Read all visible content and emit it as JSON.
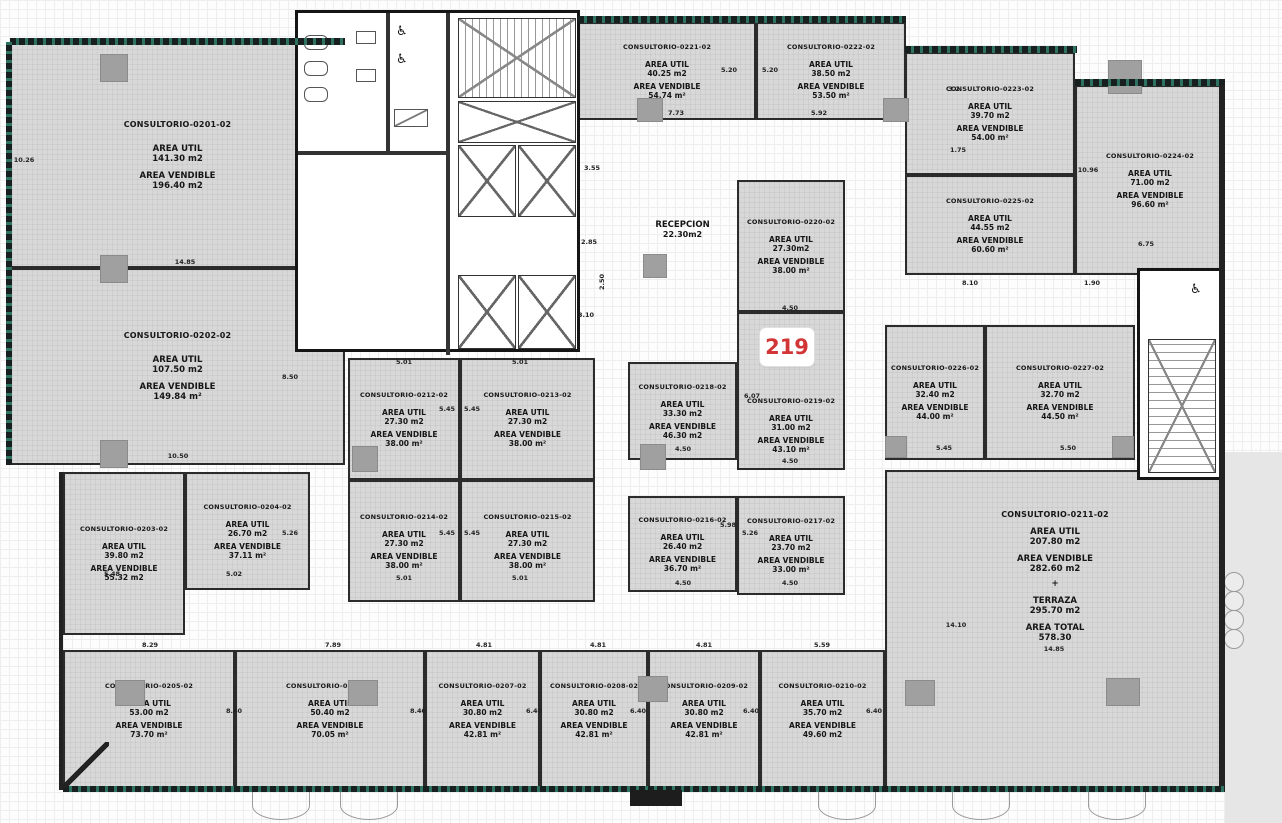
{
  "labels": {
    "area_util": "AREA UTIL",
    "area_vendible": "AREA VENDIBLE"
  },
  "marker": {
    "text": "219"
  },
  "reception": {
    "name": "RECEPCION",
    "area": "22.30m2"
  },
  "icons": {
    "wheelchair": "♿"
  },
  "rooms": [
    {
      "name": "CONSULTORIO-0201-02",
      "util": "141.30 m2",
      "vend": "196.40 m2"
    },
    {
      "name": "CONSULTORIO-0202-02",
      "util": "107.50 m2",
      "vend": "149.84 m²"
    },
    {
      "name": "CONSULTORIO-0203-02",
      "util": "39.80 m2",
      "vend": "55.32 m2"
    },
    {
      "name": "CONSULTORIO-0204-02",
      "util": "26.70 m2",
      "vend": "37.11 m²"
    },
    {
      "name": "CONSULTORIO-0205-02",
      "util": "53.00 m2",
      "vend": "73.70 m²"
    },
    {
      "name": "CONSULTORIO-0206-02",
      "util": "50.40 m2",
      "vend": "70.05 m²"
    },
    {
      "name": "CONSULTORIO-0207-02",
      "util": "30.80 m2",
      "vend": "42.81 m²"
    },
    {
      "name": "CONSULTORIO-0208-02",
      "util": "30.80 m2",
      "vend": "42.81 m²"
    },
    {
      "name": "CONSULTORIO-0209-02",
      "util": "30.80 m2",
      "vend": "42.81 m²"
    },
    {
      "name": "CONSULTORIO-0210-02",
      "util": "35.70 m2",
      "vend": "49.60 m2"
    },
    {
      "name": "CONSULTORIO-0211-02",
      "util": "207.80 m2",
      "vend": "282.60 m2",
      "plus": "+",
      "terraza_label": "TERRAZA",
      "terraza": "295.70 m2",
      "total_label": "AREA TOTAL",
      "total": "578.30"
    },
    {
      "name": "CONSULTORIO-0212-02",
      "util": "27.30 m2",
      "vend": "38.00 m²"
    },
    {
      "name": "CONSULTORIO-0213-02",
      "util": "27.30 m2",
      "vend": "38.00 m²"
    },
    {
      "name": "CONSULTORIO-0214-02",
      "util": "27.30 m2",
      "vend": "38.00 m²"
    },
    {
      "name": "CONSULTORIO-0215-02",
      "util": "27.30 m2",
      "vend": "38.00 m²"
    },
    {
      "name": "CONSULTORIO-0216-02",
      "util": "26.40 m2",
      "vend": "36.70 m²"
    },
    {
      "name": "CONSULTORIO-0217-02",
      "util": "23.70 m2",
      "vend": "33.00 m²"
    },
    {
      "name": "CONSULTORIO-0218-02",
      "util": "33.30 m2",
      "vend": "46.30 m2"
    },
    {
      "name": "CONSULTORIO-0219-02",
      "util": "31.00 m2",
      "vend": "43.10 m²"
    },
    {
      "name": "CONSULTORIO-0220-02",
      "util": "27.30m2",
      "vend": "38.00 m²"
    },
    {
      "name": "CONSULTORIO-0221-02",
      "util": "40.25 m2",
      "vend": "54.74 m²"
    },
    {
      "name": "CONSULTORIO-0222-02",
      "util": "38.50 m2",
      "vend": "53.50 m²"
    },
    {
      "name": "CONSULTORIO-0223-02",
      "util": "39.70 m2",
      "vend": "54.00 m²"
    },
    {
      "name": "CONSULTORIO-0224-02",
      "util": "71.00 m2",
      "vend": "96.60 m²"
    },
    {
      "name": "CONSULTORIO-0225-02",
      "util": "44.55 m2",
      "vend": "60.60 m²"
    },
    {
      "name": "CONSULTORIO-0226-02",
      "util": "32.40 m2",
      "vend": "44.00 m²"
    },
    {
      "name": "CONSULTORIO-0227-02",
      "util": "32.70 m2",
      "vend": "44.50 m²"
    }
  ],
  "dims": [
    "10.26",
    "14.85",
    "8.50",
    "10.50",
    "5.48",
    "5.26",
    "5.02",
    "5.01",
    "5.01",
    "5.45",
    "5.45",
    "5.45",
    "5.45",
    "5.01",
    "5.01",
    "3.55",
    "2.85",
    "2.50",
    "3.10",
    "7.73",
    "5.20",
    "5.20",
    "5.92",
    "3.2",
    "1.75",
    "10.96",
    "6.75",
    "8.10",
    "1.90",
    "4.50",
    "6.07",
    "4.50",
    "4.50",
    "5.98",
    "5.26",
    "4.50",
    "4.50",
    "5.45",
    "5.50",
    "14.10",
    "14.85",
    "8.29",
    "7.89",
    "4.81",
    "4.81",
    "4.81",
    "5.59",
    "8.40",
    "8.40",
    "6.40",
    "6.40",
    "6.40",
    "6.40"
  ]
}
